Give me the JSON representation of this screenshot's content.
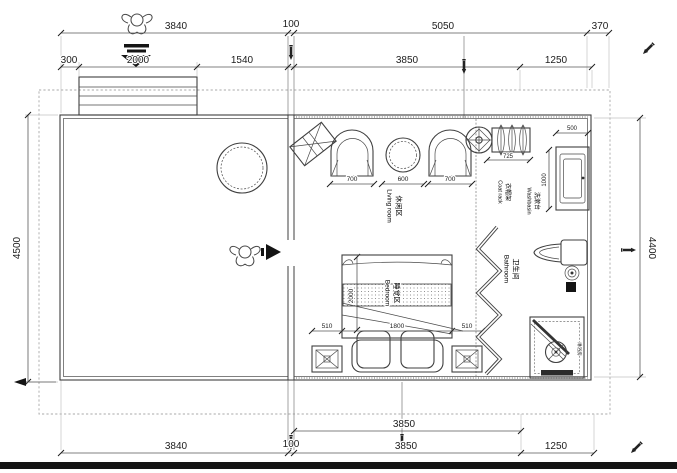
{
  "drawing": {
    "dims": {
      "top_row1": [
        "3840",
        "100",
        "5050",
        "370"
      ],
      "top_row2": [
        "300",
        "2000",
        "1540",
        "3850",
        "1250"
      ],
      "bottom_row1": [
        "3850"
      ],
      "bottom_row2": [
        "3840",
        "100",
        "3850",
        "1250"
      ],
      "left_height": "4500",
      "right_height": "4400"
    },
    "furniture_dims": {
      "chair_left": "700",
      "coffee_table": "600",
      "chair_right": "700",
      "bed_side_left": "510",
      "bed_width": "1800",
      "bed_side_right": "510",
      "bed_length": "2000",
      "washbasin_width": "500",
      "washbasin_depth": "1000",
      "coat_rack_width": "725"
    },
    "rooms": {
      "living": {
        "zh": "休闲区",
        "en": "Living room"
      },
      "bedroom": {
        "zh": "睡觉区",
        "en": "Bedroom"
      },
      "bathroom": {
        "zh": "卫生间",
        "en": "Bathroom"
      },
      "washbasin": {
        "zh": "洗漱台",
        "en": "Washbasin"
      },
      "coat_rack": {
        "zh": "衣帽架",
        "en": "Coat rack"
      },
      "shower": {
        "zh": "淋浴房"
      }
    },
    "icons": [
      "person-icon",
      "down-arrow-icon",
      "right-arrow-icon",
      "left-arrow-icon",
      "ceiling-fan-icon",
      "pen-marker-icon",
      "hanger-icon",
      "drain-icon"
    ],
    "colors": {
      "line": "#3f3f3f",
      "dim_text": "#1c1c1c",
      "boundary_dash": "#a8a8a8",
      "bottom_bar": "#141414"
    }
  }
}
